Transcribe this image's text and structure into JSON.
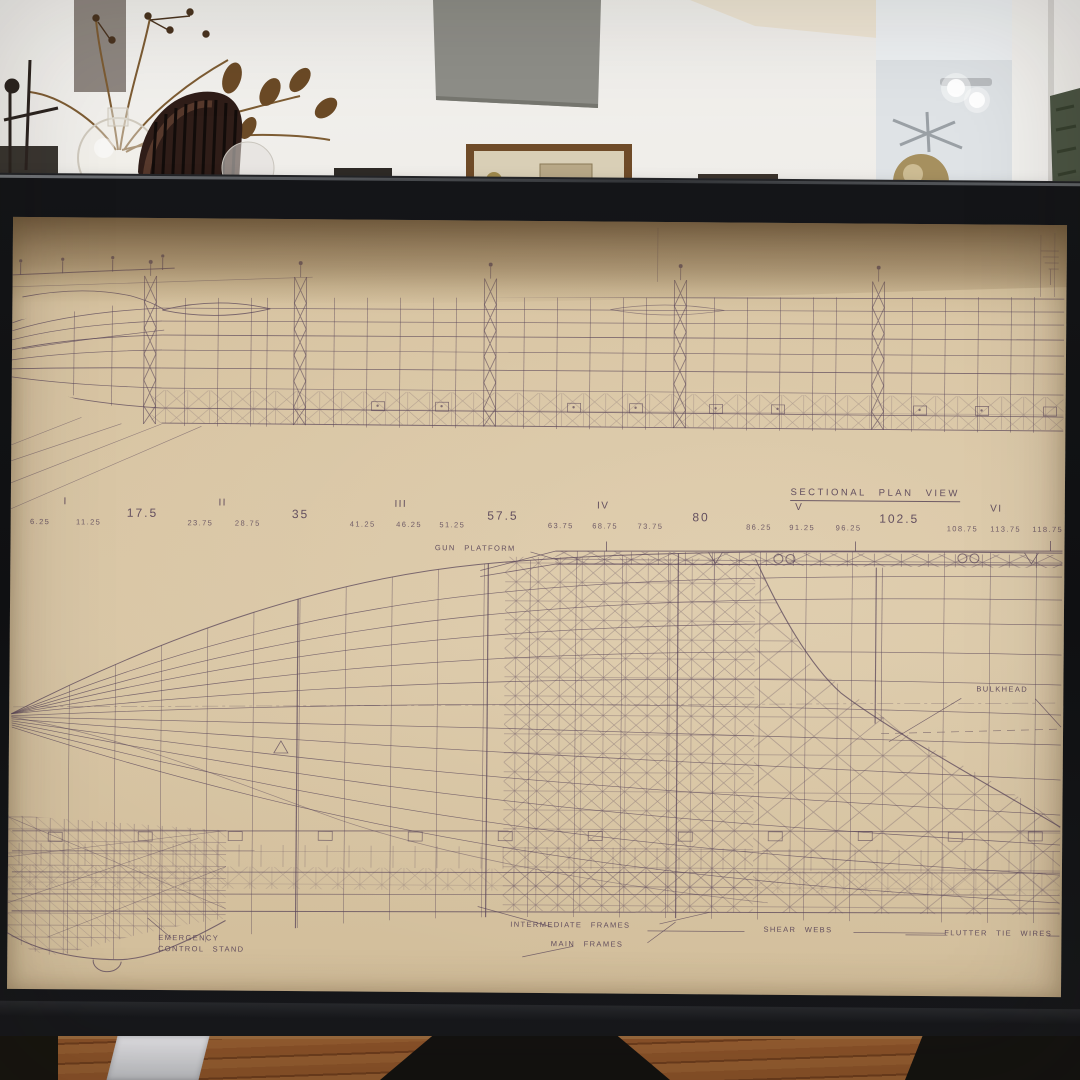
{
  "scene": {
    "description_colors": {
      "paper": "#d7c3a1",
      "ink": "#5a4659",
      "frame_black": "#17181b",
      "wall_white": "#efede9",
      "soffit_gray": "#8e8e88",
      "floor_wood": "#7c4522",
      "chair_brown": "#33201b",
      "plant_brown": "#6b4a26",
      "green_object": "#4c5544"
    }
  },
  "drawing": {
    "title": {
      "text": "SECTIONAL PLAN VIEW",
      "x": 82.0,
      "y": 34.2
    },
    "stations": {
      "roman": [
        {
          "label": "I",
          "x": 5.2,
          "y": 36.2
        },
        {
          "label": "II",
          "x": 20.1,
          "y": 36.2
        },
        {
          "label": "III",
          "x": 37.0,
          "y": 36.2
        },
        {
          "label": "IV",
          "x": 56.2,
          "y": 36.2
        },
        {
          "label": "V",
          "x": 74.8,
          "y": 36.2
        },
        {
          "label": "VI",
          "x": 93.5,
          "y": 36.2
        }
      ],
      "major": [
        {
          "label": "17.5",
          "x": 12.5,
          "y": 37.3
        },
        {
          "label": "35",
          "x": 27.5,
          "y": 37.3
        },
        {
          "label": "57.5",
          "x": 46.7,
          "y": 37.3
        },
        {
          "label": "80",
          "x": 65.5,
          "y": 37.3
        },
        {
          "label": "102.5",
          "x": 84.3,
          "y": 37.3
        }
      ],
      "minor": [
        {
          "label": "6.25",
          "x": 2.8,
          "y": 38.8
        },
        {
          "label": "11.25",
          "x": 7.4,
          "y": 38.8
        },
        {
          "label": "23.75",
          "x": 18.0,
          "y": 38.8
        },
        {
          "label": "28.75",
          "x": 22.5,
          "y": 38.8
        },
        {
          "label": "41.25",
          "x": 33.4,
          "y": 38.8
        },
        {
          "label": "46.25",
          "x": 37.8,
          "y": 38.8
        },
        {
          "label": "51.25",
          "x": 41.9,
          "y": 38.8
        },
        {
          "label": "63.75",
          "x": 52.2,
          "y": 38.8
        },
        {
          "label": "68.75",
          "x": 56.4,
          "y": 38.8
        },
        {
          "label": "73.75",
          "x": 60.7,
          "y": 38.8
        },
        {
          "label": "86.25",
          "x": 71.0,
          "y": 38.8
        },
        {
          "label": "91.25",
          "x": 75.1,
          "y": 38.8
        },
        {
          "label": "96.25",
          "x": 79.5,
          "y": 38.8
        },
        {
          "label": "108.75",
          "x": 90.3,
          "y": 38.8
        },
        {
          "label": "113.75",
          "x": 94.4,
          "y": 38.8
        },
        {
          "label": "118.75",
          "x": 98.4,
          "y": 38.8
        }
      ]
    },
    "annotations": [
      {
        "id": "gun-platform",
        "text": "GUN PLATFORM",
        "x": 44.1,
        "y": 41.8
      },
      {
        "id": "bulkhead",
        "text": "BULKHEAD",
        "x": 94.2,
        "y": 59.6
      },
      {
        "id": "emergency",
        "text": "EMERGENCY",
        "x": 17.2,
        "y": 92.6
      },
      {
        "id": "control-stand",
        "text": "CONTROL STAND",
        "x": 18.4,
        "y": 94.0
      },
      {
        "id": "intermediate-frames",
        "text": "INTERMEDIATE FRAMES",
        "x": 53.4,
        "y": 90.6
      },
      {
        "id": "main-frames",
        "text": "MAIN FRAMES",
        "x": 55.0,
        "y": 93.0
      },
      {
        "id": "shear-webs",
        "text": "SHEAR WEBS",
        "x": 75.0,
        "y": 90.9
      },
      {
        "id": "flutter-tie-wires",
        "text": "FLUTTER TIE WIRES",
        "x": 94.0,
        "y": 91.2
      }
    ]
  }
}
